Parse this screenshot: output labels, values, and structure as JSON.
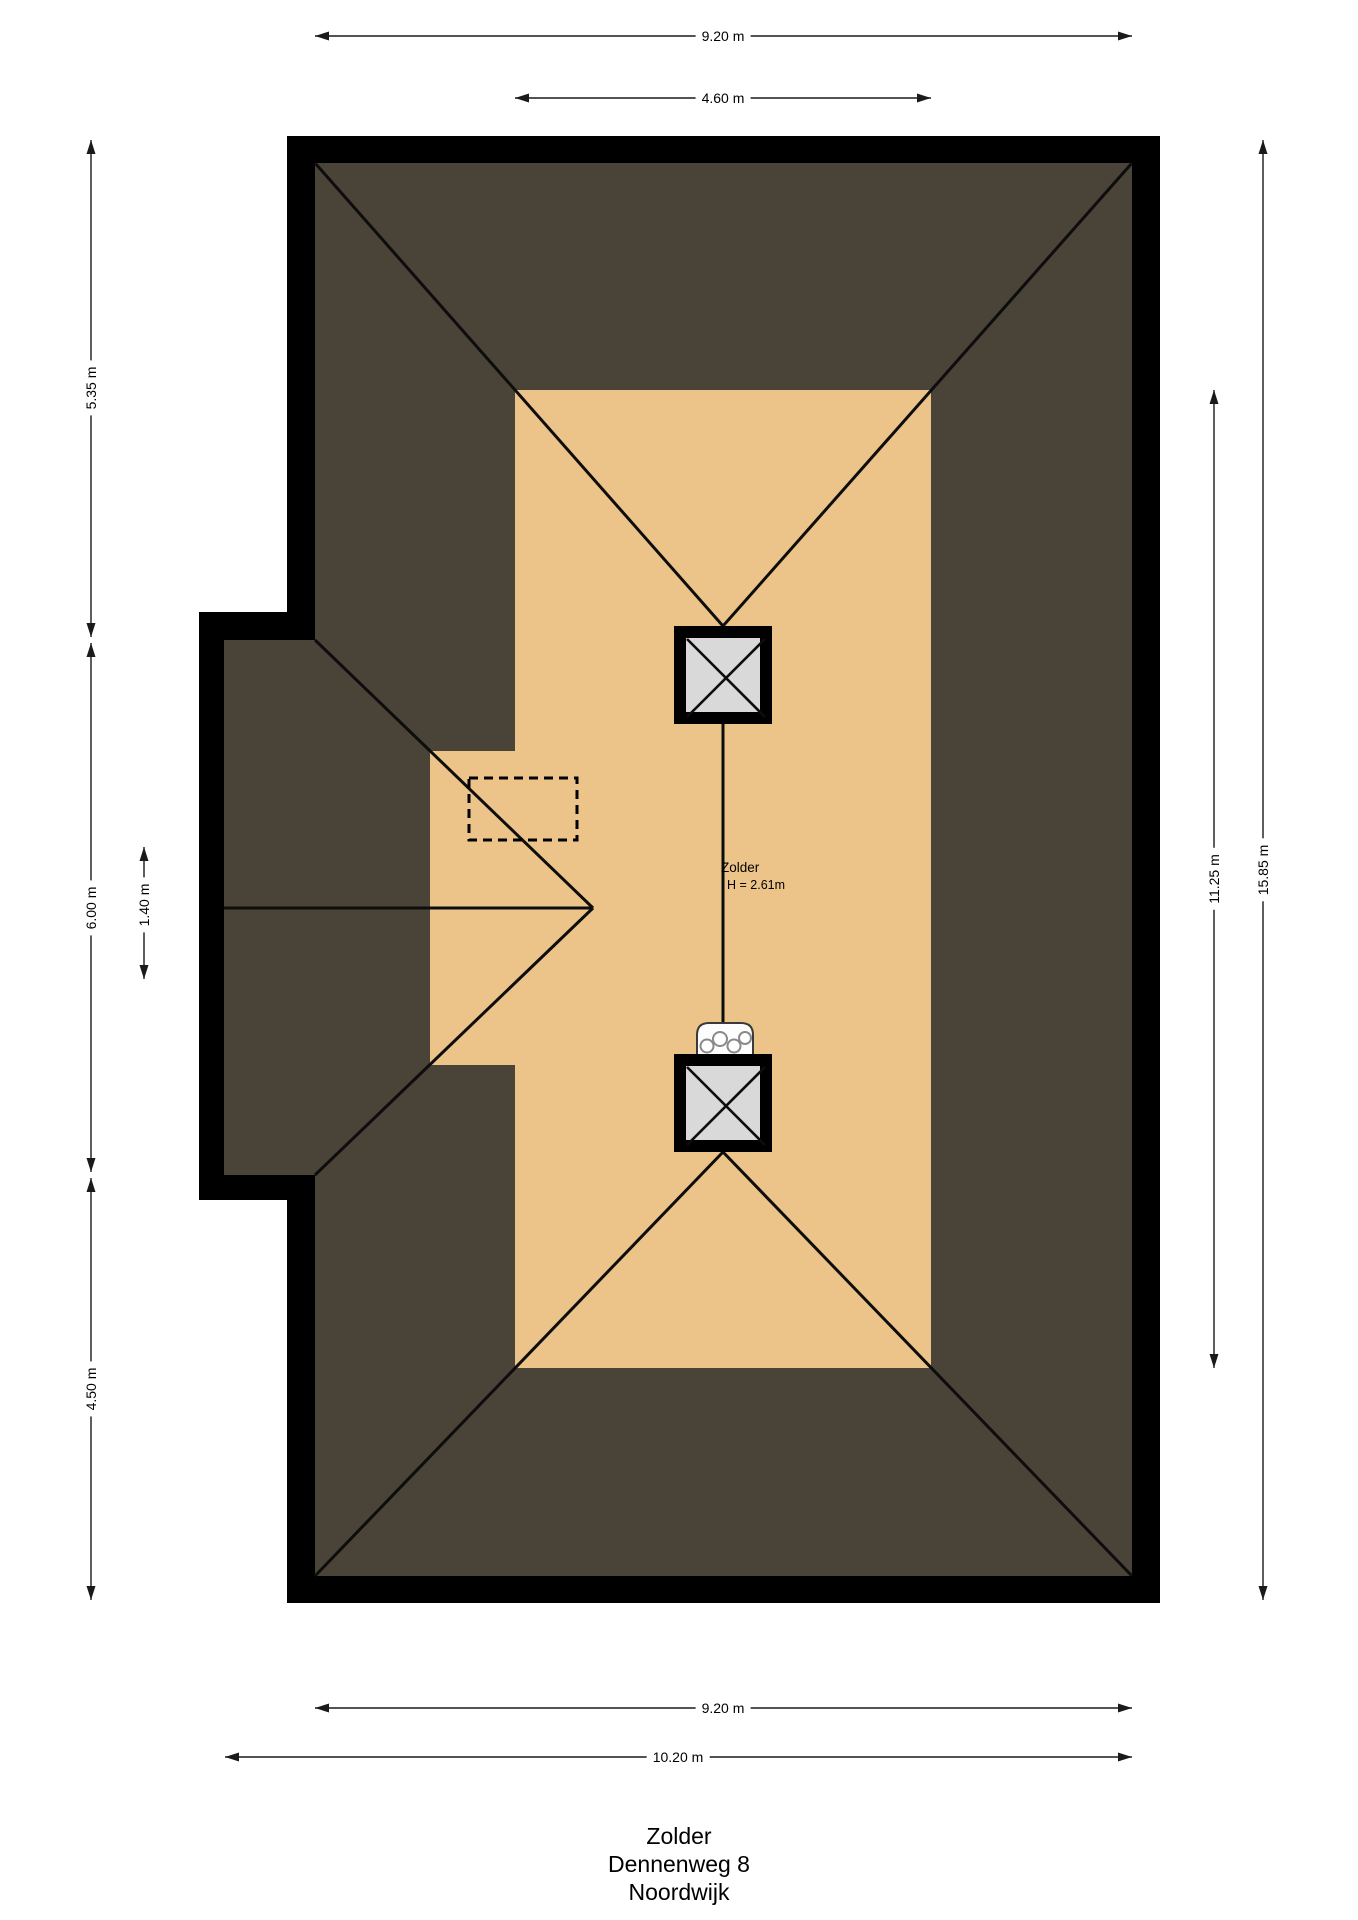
{
  "plan": {
    "room_label": "Zolder",
    "room_height_label": "H = 2.61m"
  },
  "dimensions": {
    "top_width": "9.20 m",
    "top_inner_width": "4.60 m",
    "left_upper": "5.35 m",
    "left_middle": "6.00 m",
    "left_inner": "1.40 m",
    "left_lower": "4.50 m",
    "right_inner_height": "11.25 m",
    "right_total_height": "15.85 m",
    "bottom_width": "9.20 m",
    "bottom_total_width": "10.20 m"
  },
  "title": {
    "line1": "Zolder",
    "line2": "Dennenweg 8",
    "line3": "Noordwijk"
  },
  "colors": {
    "background": "#ffffff",
    "wall": "#000000",
    "roof": "#4a4338",
    "floor": "#ecc489",
    "roof_window": "#d9d9d9",
    "line": "#000000"
  }
}
